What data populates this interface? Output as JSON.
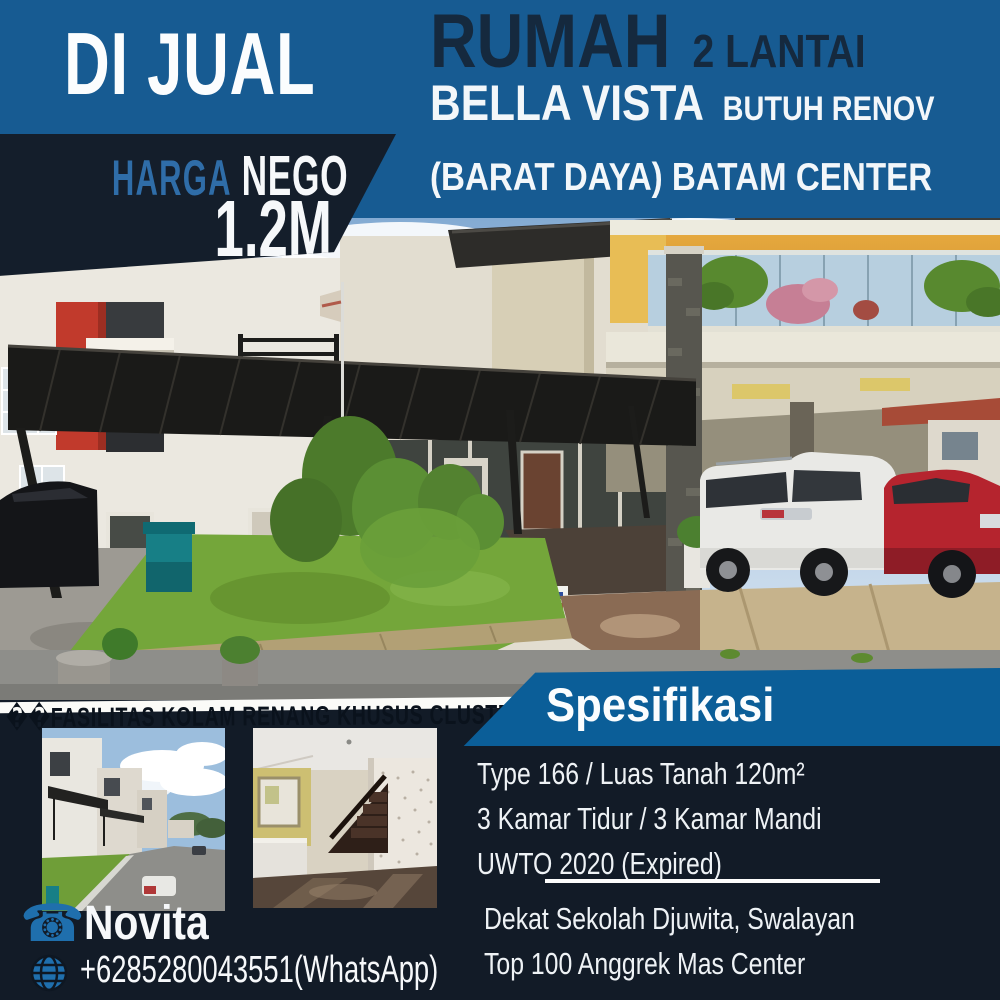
{
  "flyer": {
    "sale_badge": "DI JUAL",
    "price": {
      "label_accent": "HARGA",
      "label": "NEGO",
      "value": "1.2M"
    },
    "header": {
      "title": "RUMAH",
      "title_tag": "2 LANTAI",
      "name": "BELLA VISTA",
      "condition": "BUTUH RENOV",
      "location": "(BARAT DAYA) BATAM CENTER"
    },
    "facility_note": "��FASILITAS KOLAM RENANG KHUSUS CLUSTER",
    "specs": {
      "heading": "Spesifikasi",
      "lines": [
        "Type 166 / Luas Tanah 120m²",
        "3 Kamar Tidur / 3 Kamar Mandi",
        "UWTO 2020 (Expired)"
      ],
      "nearby": [
        "Dekat Sekolah Djuwita, Swalayan",
        "Top 100 Anggrek Mas Center"
      ]
    },
    "contact": {
      "name": "Novita",
      "phone": "+6285280043551(WhatsApp)",
      "phone_icon": "☎"
    },
    "colors": {
      "header_blue": "#175b92",
      "navy": "#131d2a",
      "banner_blue": "#0b5e98",
      "accent_blue": "#2f6da8",
      "icon_blue": "#1f6fad"
    }
  }
}
